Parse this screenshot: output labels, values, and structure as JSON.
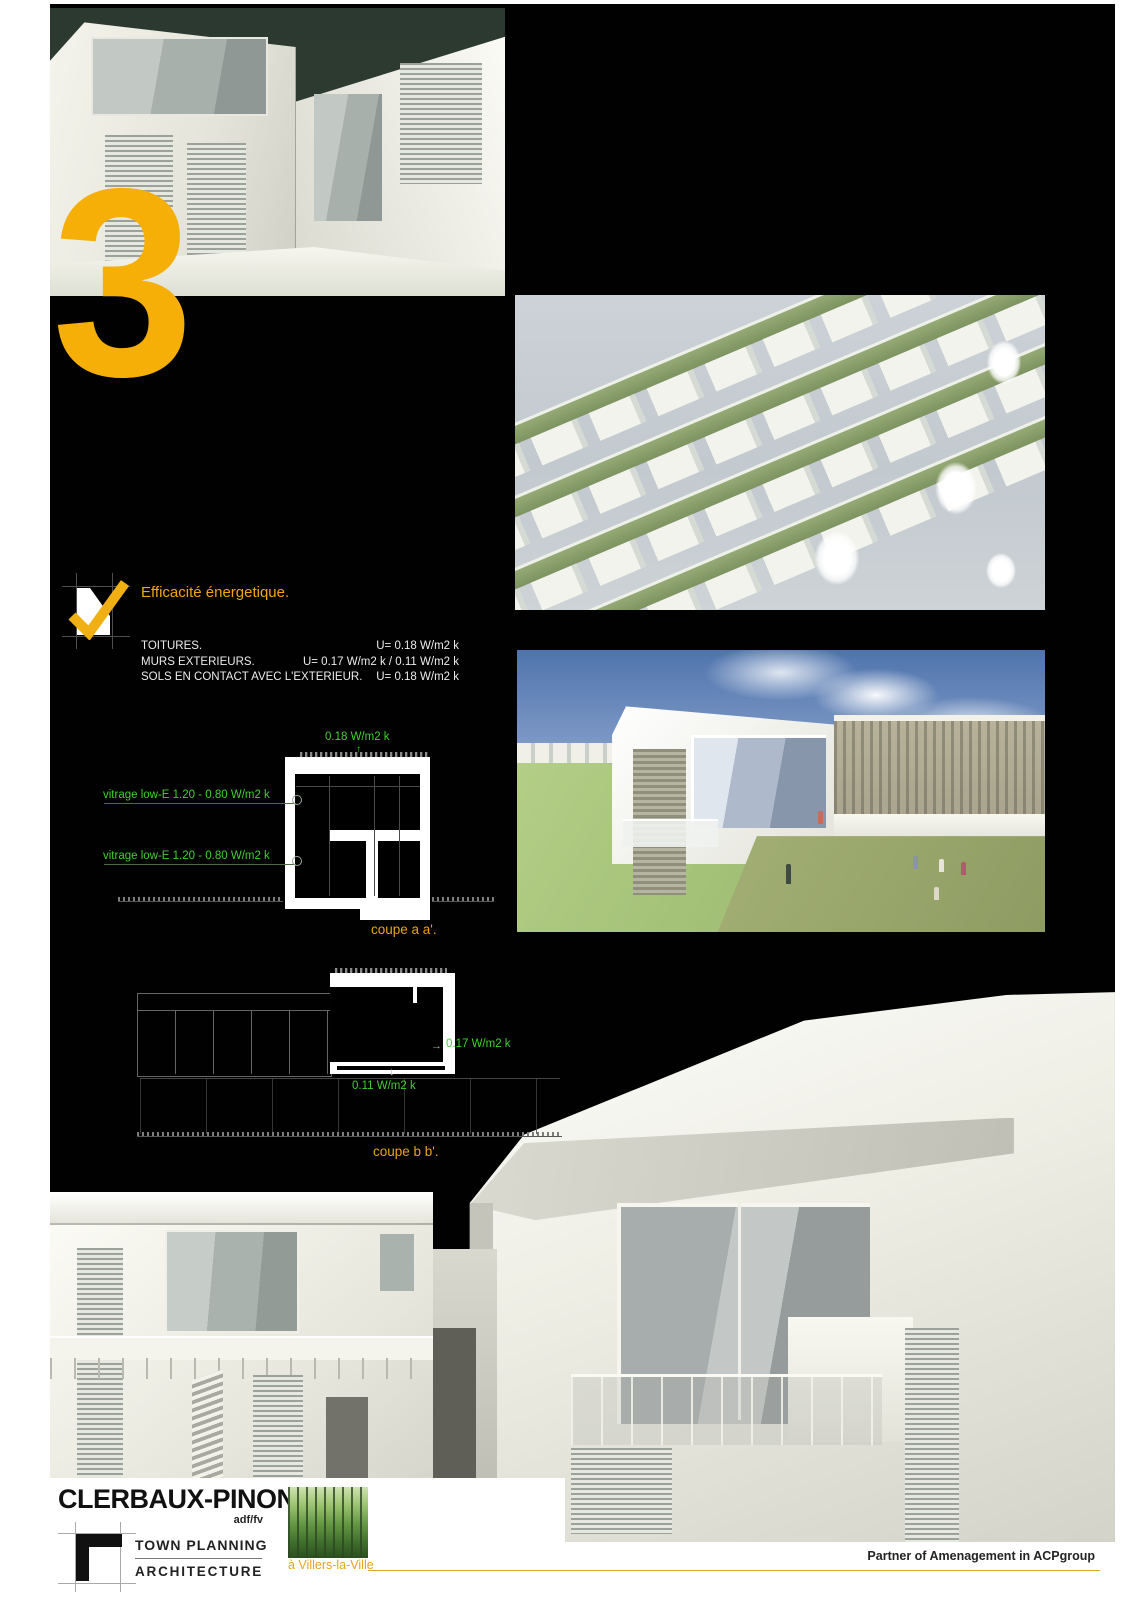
{
  "page": {
    "number": "3"
  },
  "energy_section": {
    "title": "Efficacité énergetique.",
    "u_rows": [
      {
        "label": "TOITURES.",
        "value": "U= 0.18 W/m2 k"
      },
      {
        "label": "MURS EXTERIEURS.",
        "value": "U= 0.17 W/m2 k  /  0.11 W/m2 k"
      },
      {
        "label": "SOLS EN CONTACT AVEC L'EXTERIEUR.",
        "value": "U= 0.18 W/m2 k"
      }
    ]
  },
  "coupe_a": {
    "roof_u_label": "0.18 W/m2 k",
    "arrow_up": "↑",
    "glazing_label_upper": "vitrage low-E  1.20 - 0.80 W/m2 k",
    "glazing_label_lower": "vitrage low-E  1.20 - 0.80 W/m2 k",
    "caption": "coupe a a'."
  },
  "coupe_b": {
    "arrow_right": "→",
    "wall_u_label": "0.17 W/m2 k",
    "arrow_down": "↓",
    "floor_u_label": "0.11 W/m2 k",
    "caption": "coupe b b'."
  },
  "footer": {
    "firm_name": "CLERBAUX-PINON",
    "firm_suffix": "adf/fv",
    "discipline_1": "TOWN PLANNING",
    "discipline_2": "ARCHITECTURE",
    "location": "à Villers-la-Ville",
    "partner_note": "Partner of Amenagement in ACPgroup"
  },
  "colors": {
    "accent_yellow": "#f5af07",
    "accent_orange": "#e8a417",
    "label_green": "#3fd12c",
    "board_black": "#010101",
    "dark_green_sky": "#2e3a31",
    "green_roof": "#7d9360"
  },
  "icons": {
    "check": "checkmark-icon"
  }
}
